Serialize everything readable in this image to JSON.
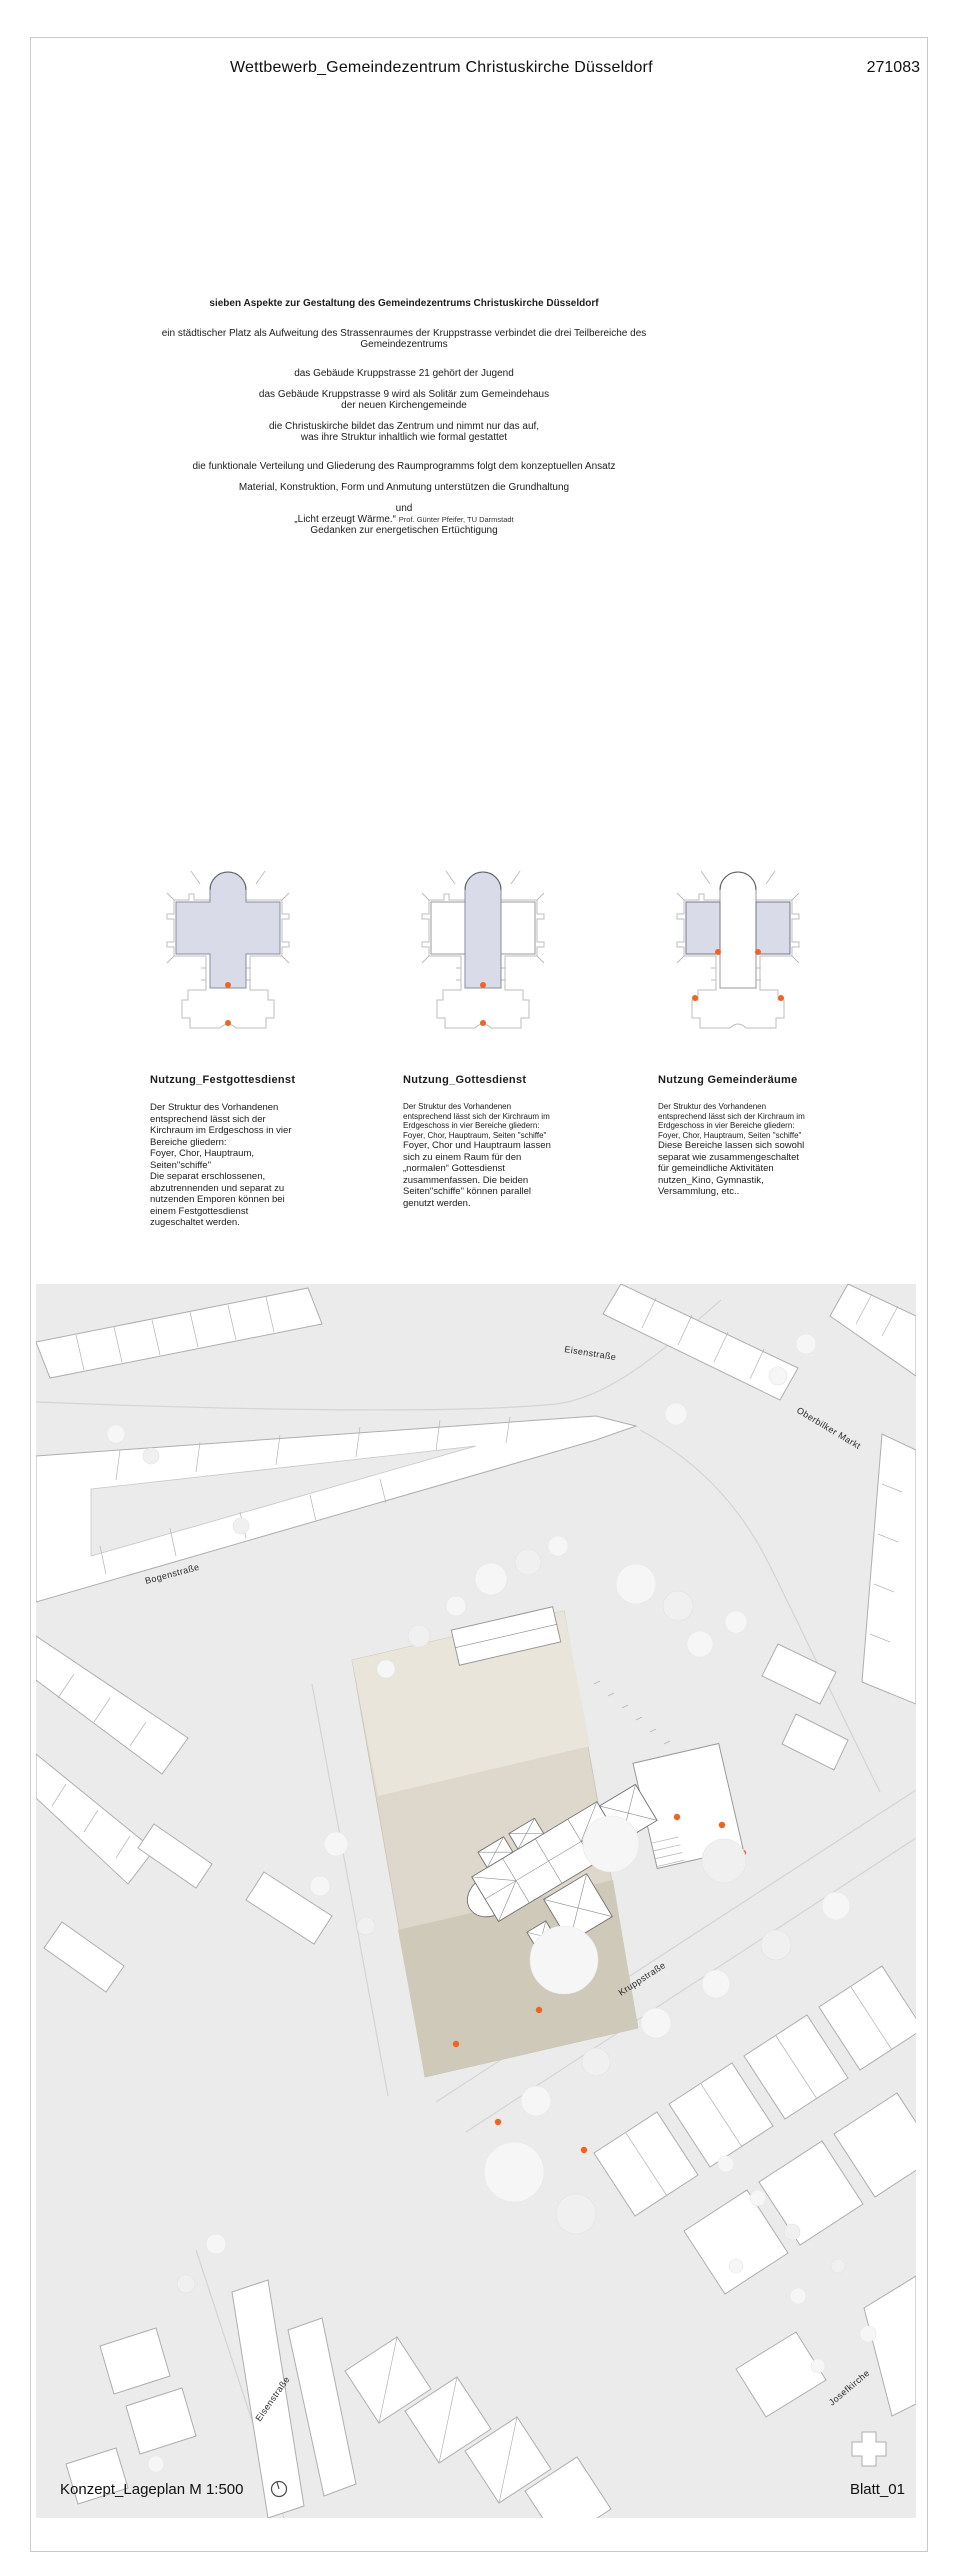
{
  "header": {
    "title": "Wettbewerb_Gemeindezentrum Christuskirche Düsseldorf",
    "sheet_number": "271083"
  },
  "concept": {
    "heading": "sieben Aspekte zur Gestaltung des Gemeindezentrums Christuskirche Düsseldorf",
    "p1a": "ein städtischer Platz als Aufweitung des Strassenraumes der Kruppstrasse verbindet die drei Teilbereiche des",
    "p1b": "Gemeindezentrums",
    "p2": "das Gebäude Kruppstrasse 21 gehört der Jugend",
    "p3a": "das Gebäude Kruppstrasse 9 wird als Solitär zum Gemeindehaus",
    "p3b": "der neuen Kirchengemeinde",
    "p4a": "die Christuskirche bildet das Zentrum und nimmt nur das auf,",
    "p4b": "was ihre Struktur inhaltlich wie formal gestattet",
    "p5": "die funktionale Verteilung und Gliederung des Raumprogramms folgt dem konzeptuellen Ansatz",
    "p6": "Material, Konstruktion, Form und Anmutung unterstützen die Grundhaltung",
    "p7": "und",
    "p8_quote": "„Licht erzeugt Wärme.“",
    "p8_credit": "Prof. Günter Pfeifer, TU Darmstadt",
    "p9": "Gedanken zur energetischen Ertüchtigung"
  },
  "diagrams": [
    {
      "title": "Nutzung_Festgottesdienst",
      "intro": "Der Struktur des Vorhandenen entsprechend lässt sich der Kirchraum im Erdgeschoss in vier Bereiche gliedern:",
      "list": "Foyer, Chor, Hauptraum, Seiten\"schiffe\"",
      "body": "Die separat erschlossenen, abzutrennenden und separat zu nutzenden Emporen können bei einem Festgottesdienst zugeschaltet werden."
    },
    {
      "title": "Nutzung_Gottesdienst",
      "intro": "Der Struktur des Vorhandenen entsprechend lässt sich der Kirchraum im Erdgeschoss in vier Bereiche gliedern:",
      "list": "Foyer, Chor, Hauptraum, Seiten \"schiffe\"",
      "body": "Foyer, Chor und Hauptraum lassen sich zu einem Raum für den „normalen“ Gottesdienst zusammenfassen. Die beiden Seiten\"schiffe\" können parallel genutzt werden."
    },
    {
      "title": "Nutzung Gemeinderäume",
      "intro": "Der Struktur des Vorhandenen entsprechend lässt sich der Kirchraum im Erdgeschoss in vier Bereiche gliedern:",
      "list": "Foyer, Chor, Hauptraum, Seiten \"schiffe\"",
      "body": "Diese Bereiche lassen sich sowohl separat wie zusammengeschaltet für gemeindliche Aktivitäten nutzen_Kino, Gymnastik, Versammlung, etc.."
    }
  ],
  "site_plan": {
    "streets": {
      "eisenstrasse_top": "Eisenstraße",
      "oberbilker_markt": "Oberbilker Markt",
      "bogenstrasse": "Bogenstraße",
      "kruppstrasse": "Kruppstraße",
      "eisenstrasse_bottom": "Eisenstraße",
      "josefkirche": "Josefkirche"
    },
    "footer": {
      "left": "Konzept_Lageplan M 1:500",
      "right": "Blatt_01"
    }
  },
  "colors": {
    "accent_orange": "#f06423",
    "plan_fill_blue": "#d9dce8",
    "site_background": "#ebebeb",
    "plaza_light": "#e9e5db",
    "plaza_dark": "#cfc9ba"
  }
}
